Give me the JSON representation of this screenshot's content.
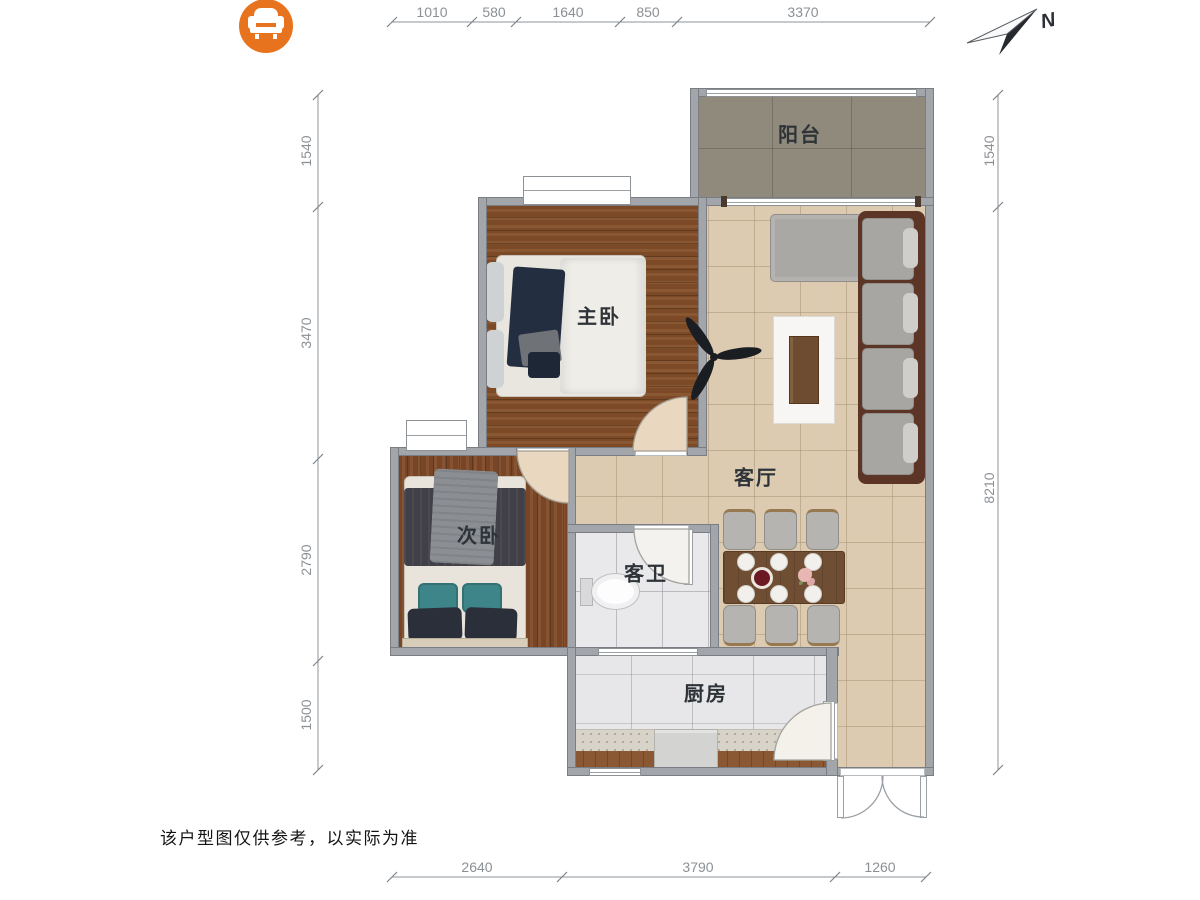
{
  "brand": {
    "icon": "armchair-icon",
    "color": "#E8731E"
  },
  "compass": {
    "label": "N"
  },
  "rooms": {
    "balcony": "阳台",
    "master_bedroom": "主卧",
    "living_room": "客厅",
    "second_bedroom": "次卧",
    "bathroom": "客卫",
    "kitchen": "厨房"
  },
  "dims": {
    "top": [
      "1010",
      "580",
      "1640",
      "850",
      "3370"
    ],
    "left": [
      "1540",
      "3470",
      "2790",
      "1500"
    ],
    "right": [
      "1540",
      "8210"
    ],
    "bottom": [
      "2640",
      "3790",
      "1260"
    ]
  },
  "disclaimer": "该户型图仅供参考，以实际为准",
  "colors": {
    "logo_orange": "#E8731E",
    "wall_gray": "#A2A6AA",
    "wood_floor": "#7C4A26",
    "tile_beige": "#DCCBB1",
    "balcony_stone": "#8F8A7C",
    "sofa_frame_brown": "#5C3526",
    "accent_teal": "#3D8588",
    "dim_text": "#8B9095"
  }
}
